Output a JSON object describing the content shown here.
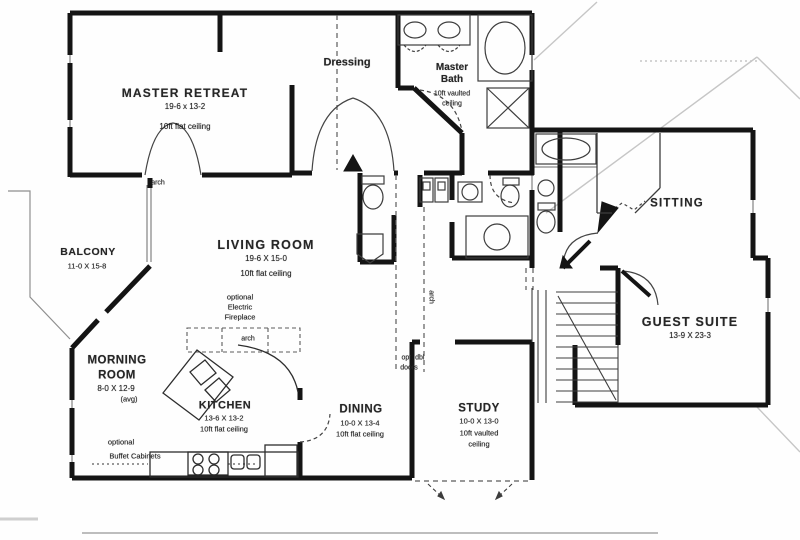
{
  "meta": {
    "drawing_type": "residential floor plan"
  },
  "colors": {
    "wall": "#141414",
    "fixture_line": "#3d3d3d",
    "roofline": "#c6c6c6",
    "background": "#fefefe",
    "text": "#262626"
  },
  "rooms": {
    "master_retreat": {
      "name": "MASTER RETREAT",
      "dims": "19-6 x 13-2",
      "ceiling": "10ft flat ceiling"
    },
    "dressing": {
      "name": "Dressing"
    },
    "master_bath": {
      "name_line1": "Master",
      "name_line2": "Bath",
      "ceiling_line1": "10ft vaulted",
      "ceiling_line2": "ceiling"
    },
    "balcony": {
      "name": "BALCONY",
      "dims": "11-0 X 15-8"
    },
    "living_room": {
      "name": "LIVING ROOM",
      "dims": "19-6 X 15-0",
      "ceiling": "10ft flat ceiling"
    },
    "sitting": {
      "name": "SITTING"
    },
    "guest_suite": {
      "name": "GUEST SUITE",
      "dims": "13-9 X 23-3"
    },
    "morning_room": {
      "name_line1": "MORNING",
      "name_line2": "ROOM",
      "dims": "8-0 X 12-9",
      "note": "(avg)"
    },
    "kitchen": {
      "name": "KITCHEN",
      "dims": "13-6 X 13-2",
      "ceiling": "10ft flat ceiling"
    },
    "dining": {
      "name": "DINING",
      "dims": "10-0 X 13-4",
      "ceiling": "10ft flat ceiling"
    },
    "study": {
      "name": "STUDY",
      "dims": "10-0 X 13-0",
      "ceiling_line1": "10ft vaulted",
      "ceiling_line2": "ceiling"
    }
  },
  "annotations": {
    "arch_master": "arch",
    "arch_fireplace": "arch",
    "arch_hall": "arch",
    "fireplace_line1": "optional",
    "fireplace_line2": "Electric",
    "fireplace_line3": "Fireplace",
    "dbl_doors_line1": "opt. dbl",
    "dbl_doors_line2": "doors",
    "buffet_line1": "optional",
    "buffet_line2": "Buffet Cabinets"
  }
}
